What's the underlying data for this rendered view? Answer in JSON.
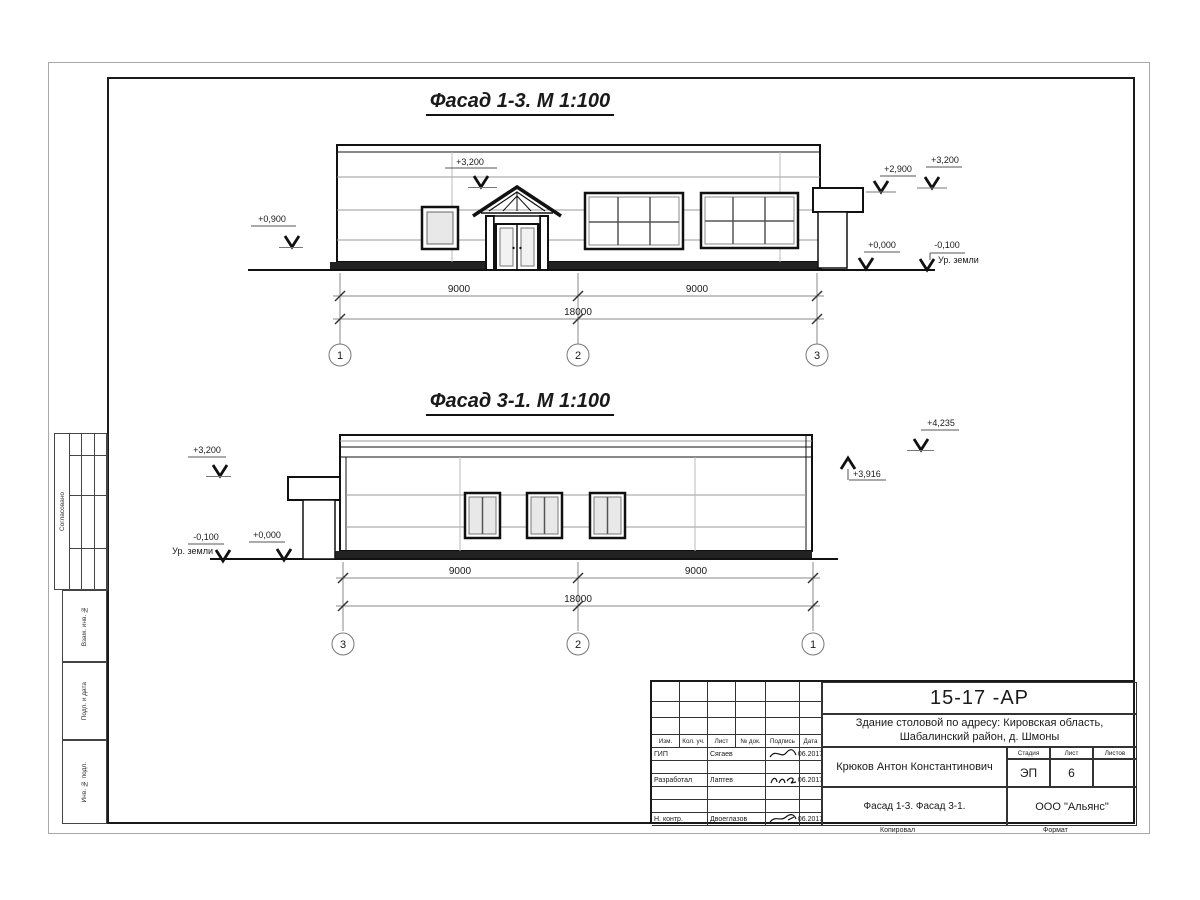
{
  "facade1": {
    "title": "Фасад 1-3.  М 1:100",
    "marks": {
      "peak": "+3,200",
      "left": "+0,900",
      "canopy": "+2,900",
      "right": "+3,200",
      "zero": "+0,000",
      "ground": "-0,100",
      "ground_label": "Ур. земли"
    },
    "dims": {
      "left": "9000",
      "right": "9000",
      "total": "18000"
    },
    "axes": [
      "1",
      "2",
      "3"
    ]
  },
  "facade2": {
    "title": "Фасад 3-1.  М 1:100",
    "marks": {
      "left": "+3,200",
      "top": "+4,235",
      "roof": "+3,916",
      "zero": "+0,000",
      "ground": "-0,100",
      "ground_label": "Ур. земли"
    },
    "dims": {
      "left": "9000",
      "right": "9000",
      "total": "18000"
    },
    "axes": [
      "3",
      "2",
      "1"
    ]
  },
  "side_labels": {
    "approved": "Согласовано",
    "replace_inv": "Взам. инв. №",
    "sign_date": "Подп. и дата",
    "inv_orig": "Инв. № подл."
  },
  "titleblock": {
    "doc_number": "15-17 -АР",
    "project_line1": "Здание столовой по адресу: Кировская область,",
    "project_line2": "Шабалинский район, д. Шмоны",
    "headers": [
      "Изм.",
      "Кол. уч.",
      "Лист",
      "№ док.",
      "Подпись",
      "Дата"
    ],
    "rows": [
      {
        "role": "ГИП",
        "name": "Сягаев",
        "date": "06.2017"
      },
      {
        "role": "",
        "name": "",
        "date": ""
      },
      {
        "role": "Разработал",
        "name": "Лаптев",
        "date": "06.2017"
      },
      {
        "role": "",
        "name": "",
        "date": ""
      },
      {
        "role": "",
        "name": "",
        "date": ""
      },
      {
        "role": "Н. контр.",
        "name": "Двоеглазов",
        "date": "06.2017"
      }
    ],
    "author": "Крюков Антон Константинович",
    "stage_label": "Стадия",
    "sheet_label": "Лист",
    "sheets_label": "Листов",
    "stage": "ЭП",
    "sheet": "6",
    "sheets": "",
    "drawing_name": "Фасад 1-3. Фасад 3-1.",
    "company": "ООО \"Альянс\""
  },
  "footer": {
    "copied": "Копировал",
    "format": "Формат"
  }
}
